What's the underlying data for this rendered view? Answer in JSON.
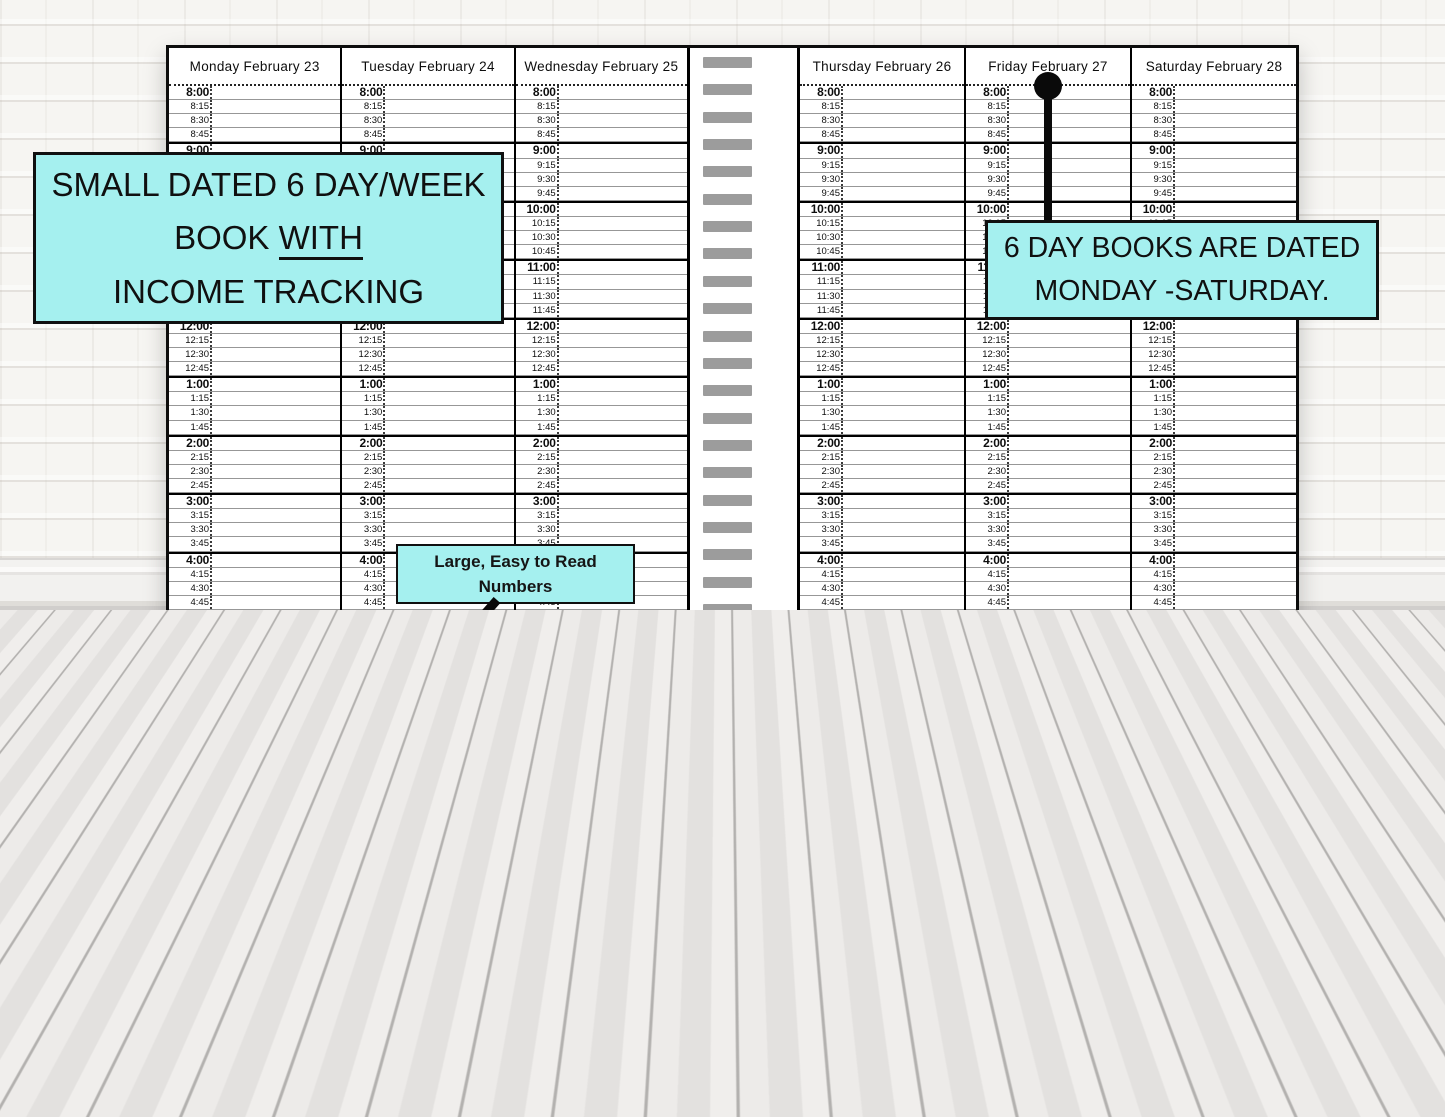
{
  "annotations": {
    "main_callout": {
      "line1": "SMALL DATED 6 DAY/WEEK",
      "line2_prefix": "BOOK ",
      "line2_underlined": "WITH",
      "line3": "INCOME TRACKING"
    },
    "dated_callout": {
      "line1": "6 DAY BOOKS ARE DATED",
      "line2": "MONDAY -SATURDAY."
    },
    "numbers_callout": {
      "line1": "Large,  Easy to Read",
      "line2": "Numbers"
    },
    "daily_totals_callout": "DAILY TOTALS",
    "magnifier_note_line1": "Enlarged",
    "magnifier_note_line2": "to show detail"
  },
  "planner": {
    "left_page_days": [
      "Monday February 23",
      "Tuesday February 24",
      "Wednesday February 25"
    ],
    "right_page_days": [
      "Thursday February 26",
      "Friday February 27",
      "Saturday February 28"
    ],
    "time_slots": [
      "8:00",
      "8:15",
      "8:30",
      "8:45",
      "9:00",
      "9:15",
      "9:30",
      "9:45",
      "10:00",
      "10:15",
      "10:30",
      "10:45",
      "11:00",
      "11:15",
      "11:30",
      "11:45",
      "12:00",
      "12:15",
      "12:30",
      "12:45",
      "1:00",
      "1:15",
      "1:30",
      "1:45",
      "2:00",
      "2:15",
      "2:30",
      "2:45",
      "3:00",
      "3:15",
      "3:30",
      "3:45",
      "4:00",
      "4:15",
      "4:30",
      "4:45",
      "5:00",
      "5:15",
      "5:30",
      "5:45",
      "6:00",
      "6:15",
      "6:30",
      "6:45",
      "7:00",
      "7:15",
      "7:30",
      "7:45",
      "8:00",
      "8:15",
      "8:30",
      "8:45",
      "9:00"
    ],
    "magnifier_times": [
      "6:00",
      "6:15",
      "6:30",
      "6:45",
      "7:00",
      "7:15",
      "7:30",
      "7:45",
      "8:00"
    ],
    "income_columns": [
      "Cash",
      "Checks",
      "Other"
    ],
    "income_rows": [
      "INCOME",
      "TIPS"
    ],
    "page_margin_copyright": "© FryeCakesDesigns"
  },
  "watermark": "©FRYECAKESDESIGNS",
  "colors": {
    "callout_bg": "#a5f0ef",
    "magnifier_bg": "#c9f4f4",
    "spiral_gray": "#9c9c9c"
  }
}
